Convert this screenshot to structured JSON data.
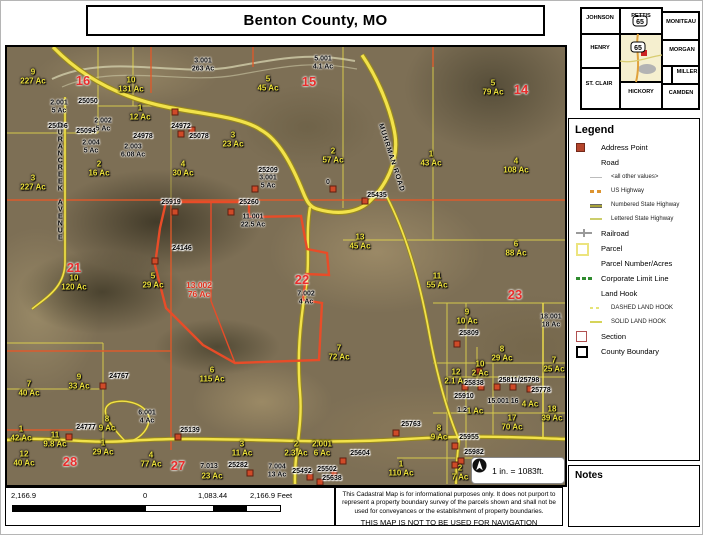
{
  "title": "Benton County, MO",
  "inset": {
    "highlight_color": "#f5efcf",
    "highway_shield": "65",
    "marker_color": "#cc2222",
    "counties": [
      {
        "name": "JOHNSON",
        "x": 22,
        "y": 14
      },
      {
        "name": "PETTIS",
        "x": 63,
        "y": 12
      },
      {
        "name": "MONITEAU",
        "x": 103,
        "y": 18
      },
      {
        "name": "HENRY",
        "x": 22,
        "y": 44
      },
      {
        "name": "MORGAN",
        "x": 104,
        "y": 46
      },
      {
        "name": "MILLER",
        "x": 109,
        "y": 68
      },
      {
        "name": "ST. CLAIR",
        "x": 21,
        "y": 80
      },
      {
        "name": "HICKORY",
        "x": 63,
        "y": 88
      },
      {
        "name": "CAMDEN",
        "x": 103,
        "y": 89
      }
    ]
  },
  "legend": {
    "title": "Legend",
    "items": [
      {
        "icon": "address-point",
        "label": "Address Point",
        "sub": false
      },
      {
        "icon": "blank",
        "label": "Road",
        "sub": false
      },
      {
        "icon": "road-other",
        "label": "<all other values>",
        "sub": true
      },
      {
        "icon": "us-highway",
        "label": "US Highway",
        "sub": true
      },
      {
        "icon": "numbered-state-highway",
        "label": "Numbered State Highway",
        "sub": true
      },
      {
        "icon": "lettered-state-highway",
        "label": "Lettered State Highway",
        "sub": true
      },
      {
        "icon": "railroad",
        "label": "Railroad",
        "sub": false
      },
      {
        "icon": "parcel",
        "label": "Parcel",
        "sub": false
      },
      {
        "icon": "blank",
        "label": "Parcel Number/Acres",
        "sub": false
      },
      {
        "icon": "corporate-limit",
        "label": "Corporate Limit Line",
        "sub": false
      },
      {
        "icon": "blank",
        "label": "Land Hook",
        "sub": false
      },
      {
        "icon": "dashed-land-hook",
        "label": "DASHED LAND HOOK",
        "sub": true
      },
      {
        "icon": "solid-land-hook",
        "label": "SOLID LAND HOOK",
        "sub": true
      },
      {
        "icon": "section",
        "label": "Section",
        "sub": false
      },
      {
        "icon": "county-boundary",
        "label": "County Boundary",
        "sub": false
      }
    ]
  },
  "notes": {
    "title": "Notes"
  },
  "scale_note": "1 in. = 1083ft.",
  "scalebar": {
    "labels": [
      "2,166.9",
      "0",
      "1,083.44",
      "2,166.9 Feet"
    ]
  },
  "disclaimer": {
    "line1": "This Cadastral Map is for informational purposes only.  It does not purport to represent a property boundary survey of the parcels shown and shall not be used for conveyances or the establishment of property boundaries.",
    "line2": "THIS MAP IS NOT TO BE USED FOR NAVIGATION"
  },
  "map": {
    "colors": {
      "parcel_line": "#ece04a",
      "section_line": "#e05a2a",
      "highlight_parcel": "#e84c28",
      "address_point": "#cf4a28",
      "section_number": "#e82e2c",
      "parcel_text_yellow": "#eee23c"
    },
    "road_names": [
      "DURANCREEK AVENUE",
      "MUHRMAN ROAD"
    ],
    "labels": [
      [
        26,
        30,
        "9|227 Ac",
        "y"
      ],
      [
        124,
        38,
        "10|131 Ac",
        "y"
      ],
      [
        133,
        66,
        "1|12 Ac",
        "y"
      ],
      [
        26,
        136,
        "3|227 Ac",
        "y"
      ],
      [
        92,
        122,
        "2|16 Ac",
        "y"
      ],
      [
        176,
        122,
        "4|30 Ac",
        "y"
      ],
      [
        261,
        37,
        "5|45 Ac",
        "y"
      ],
      [
        226,
        93,
        "3|23 Ac",
        "y"
      ],
      [
        326,
        109,
        "2|57 Ac",
        "y"
      ],
      [
        424,
        112,
        "1|43 Ac",
        "y"
      ],
      [
        486,
        41,
        "5|79 Ac",
        "y"
      ],
      [
        509,
        119,
        "4|108 Ac",
        "y"
      ],
      [
        353,
        195,
        "13|45 Ac",
        "y"
      ],
      [
        67,
        236,
        "10|120 Ac",
        "y"
      ],
      [
        146,
        234,
        "5|29 Ac",
        "y"
      ],
      [
        430,
        234,
        "11|55 Ac",
        "y"
      ],
      [
        509,
        202,
        "6|88 Ac",
        "y"
      ],
      [
        332,
        306,
        "7|72 Ac",
        "y"
      ],
      [
        205,
        328,
        "6|115 Ac",
        "y"
      ],
      [
        22,
        342,
        "7|40 Ac",
        "y"
      ],
      [
        72,
        335,
        "9|33 Ac",
        "y"
      ],
      [
        100,
        377,
        "8|9 Ac",
        "y"
      ],
      [
        14,
        387,
        "1|42 Ac",
        "y"
      ],
      [
        17,
        412,
        "12|40 Ac",
        "y"
      ],
      [
        48,
        393,
        "11|9.8 Ac",
        "y"
      ],
      [
        96,
        401,
        "1|29 Ac",
        "y"
      ],
      [
        144,
        413,
        "4|77 Ac",
        "y"
      ],
      [
        235,
        402,
        "3|11 Ac",
        "y"
      ],
      [
        289,
        402,
        "2|2.3 Ac",
        "y"
      ],
      [
        315,
        402,
        "2.001|6 Ac",
        "y"
      ],
      [
        495,
        307,
        "8|29 Ac",
        "y"
      ],
      [
        473,
        322,
        "10|2 Ac",
        "y"
      ],
      [
        547,
        318,
        "7|25 Ac",
        "y"
      ],
      [
        449,
        330,
        "12|2.1 Ac",
        "y"
      ],
      [
        460,
        270,
        "9|10 Ac",
        "y"
      ],
      [
        505,
        376,
        "17|70 Ac",
        "y"
      ],
      [
        545,
        367,
        "18|39 Ac",
        "y"
      ],
      [
        432,
        386,
        "8|9 Ac",
        "y"
      ],
      [
        394,
        422,
        "1|110 Ac",
        "y"
      ],
      [
        453,
        426,
        "2|7 Ac",
        "y"
      ],
      [
        523,
        358,
        "4 Ac",
        "y"
      ],
      [
        468,
        365,
        "1 Ac",
        "y"
      ],
      [
        205,
        430,
        "23 Ac",
        "y"
      ],
      [
        52,
        60,
        "2.001|5 Ac",
        "b"
      ],
      [
        96,
        78,
        "2.002|5 Ac",
        "b"
      ],
      [
        84,
        100,
        "2.004|5 Ac",
        "b"
      ],
      [
        126,
        104,
        "2.003|6.08 Ac",
        "b"
      ],
      [
        196,
        18,
        "3.001|263 Ac",
        "b"
      ],
      [
        316,
        16,
        "5.001|4.1 Ac",
        "b"
      ],
      [
        261,
        135,
        "3.001|5 Ac",
        "b"
      ],
      [
        246,
        174,
        "11.001|22.5 Ac",
        "b"
      ],
      [
        299,
        251,
        "7.002|4 Ac",
        "b"
      ],
      [
        140,
        370,
        "6.001|4 Ac",
        "b"
      ],
      [
        270,
        424,
        "7.004|13 Ac",
        "b"
      ],
      [
        202,
        420,
        "7.013",
        "b"
      ],
      [
        544,
        274,
        "18.001|18 Ac",
        "b"
      ],
      [
        496,
        355,
        "15.001 16",
        "b"
      ],
      [
        455,
        364,
        "1.2",
        "b"
      ],
      [
        321,
        136,
        "0",
        "b"
      ],
      [
        81,
        55,
        "25050",
        "a"
      ],
      [
        51,
        80,
        "25006",
        "a"
      ],
      [
        79,
        85,
        "25094",
        "a"
      ],
      [
        136,
        90,
        "24978",
        "a"
      ],
      [
        174,
        80,
        "24972",
        "a"
      ],
      [
        192,
        90,
        "25078",
        "a"
      ],
      [
        261,
        124,
        "25209",
        "a"
      ],
      [
        242,
        156,
        "25260",
        "a"
      ],
      [
        370,
        149,
        "25435",
        "a"
      ],
      [
        164,
        156,
        "25919",
        "a"
      ],
      [
        175,
        202,
        "24146",
        "a"
      ],
      [
        112,
        330,
        "24767",
        "a"
      ],
      [
        79,
        381,
        "24777",
        "a"
      ],
      [
        183,
        384,
        "25139",
        "a"
      ],
      [
        231,
        419,
        "25282",
        "a"
      ],
      [
        295,
        425,
        "25492",
        "a"
      ],
      [
        320,
        423,
        "25502",
        "a"
      ],
      [
        325,
        432,
        "25638",
        "a"
      ],
      [
        353,
        407,
        "25604",
        "a"
      ],
      [
        404,
        378,
        "25763",
        "a"
      ],
      [
        462,
        391,
        "25955",
        "a"
      ],
      [
        467,
        406,
        "25982",
        "a"
      ],
      [
        462,
        287,
        "25809",
        "a"
      ],
      [
        467,
        337,
        "25838",
        "a"
      ],
      [
        512,
        334,
        "25811/25798",
        "a"
      ],
      [
        534,
        344,
        "25778",
        "a"
      ],
      [
        457,
        350,
        "25910",
        "a"
      ],
      [
        76,
        34,
        "16",
        "r"
      ],
      [
        302,
        35,
        "15",
        "r"
      ],
      [
        514,
        43,
        "14",
        "r"
      ],
      [
        67,
        221,
        "21",
        "r"
      ],
      [
        295,
        233,
        "22",
        "r"
      ],
      [
        508,
        248,
        "23",
        "r"
      ],
      [
        63,
        415,
        "28",
        "r"
      ],
      [
        171,
        419,
        "27",
        "r"
      ],
      [
        192,
        243,
        "13.002|76 Ac",
        "rp"
      ],
      [
        53,
        135,
        "DURANCREEK AVENUE",
        "roadv"
      ],
      [
        384,
        111,
        "MUHRMAN ROAD",
        "road",
        72
      ]
    ],
    "address_squares": [
      [
        168,
        65
      ],
      [
        174,
        87
      ],
      [
        185,
        83
      ],
      [
        148,
        214
      ],
      [
        168,
        165
      ],
      [
        224,
        165
      ],
      [
        248,
        142
      ],
      [
        358,
        154
      ],
      [
        326,
        142
      ],
      [
        96,
        339
      ],
      [
        62,
        390
      ],
      [
        171,
        390
      ],
      [
        336,
        414
      ],
      [
        243,
        426
      ],
      [
        303,
        430
      ],
      [
        327,
        427
      ],
      [
        313,
        435
      ],
      [
        389,
        386
      ],
      [
        448,
        399
      ],
      [
        454,
        414
      ],
      [
        450,
        297
      ],
      [
        458,
        340
      ],
      [
        474,
        340
      ],
      [
        490,
        340
      ],
      [
        506,
        340
      ],
      [
        523,
        342
      ],
      [
        448,
        418
      ],
      [
        472,
        324
      ]
    ]
  }
}
